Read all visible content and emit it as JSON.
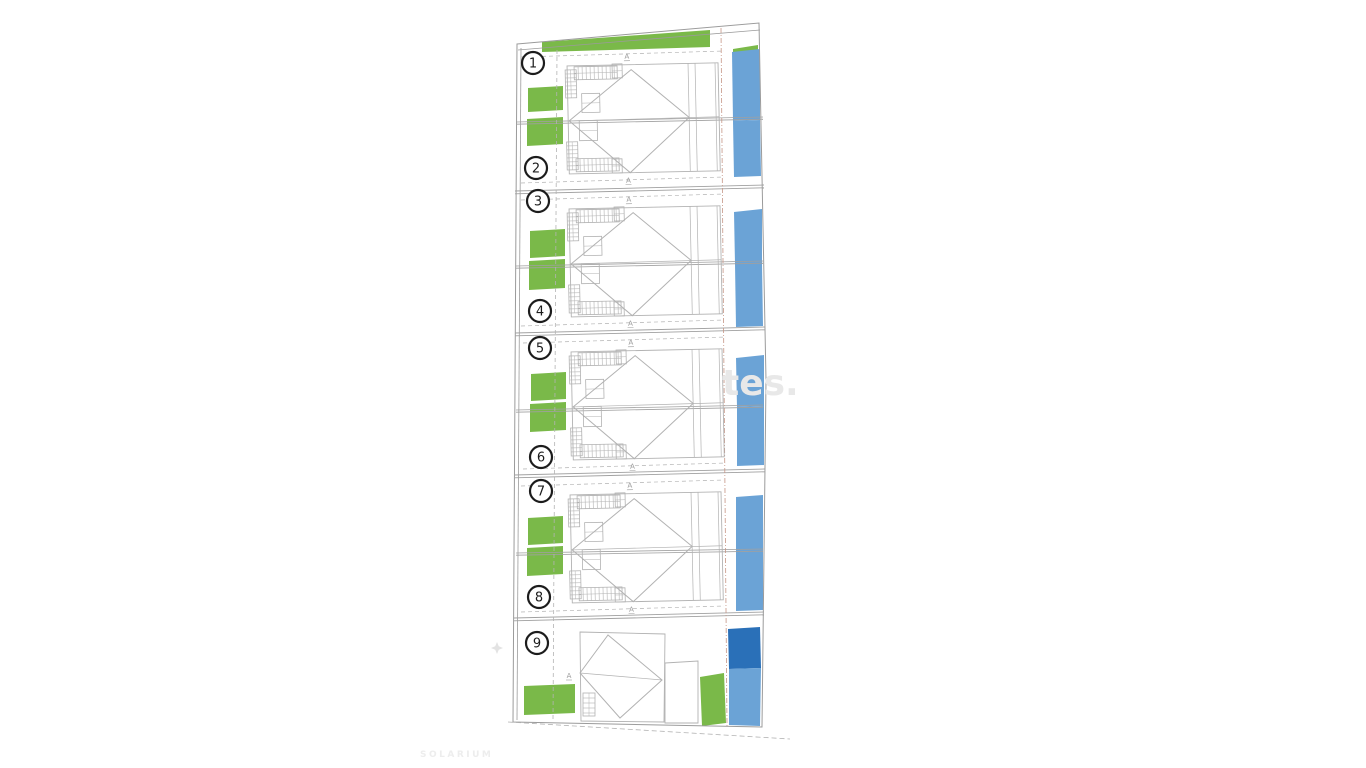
{
  "plan": {
    "colors": {
      "green": "#7ab949",
      "pool": "#6ba3d6",
      "pool_dark": "#2a70b8",
      "boundary_line": "#9b9b9b",
      "plot_line": "#a0a0a0",
      "building_line": "#b2b2b2",
      "dash_gray": "#b3b3b3",
      "dash_red": "#c59585",
      "circle_stroke": "#1c1c1c",
      "number_color": "#1c1c1c",
      "marker_gray": "#9a9a9a",
      "watermark_gray": "#e8e8e8"
    },
    "boundary": {
      "outer": "517,44 759,23 766,380 762,727 513,722",
      "inner_lines": [
        [
          518,
          50,
          760,
          30
        ],
        [
          521,
          48,
          517,
          720
        ]
      ],
      "bottom_dash": [
        508,
        722,
        790,
        739
      ]
    },
    "greens": [
      "542,42 710,30 710,47 542,52",
      "733,49 758,45 758,53 733,54",
      "528,88 563,86 563,110 528,112",
      "527,119 563,117 563,144 527,146",
      "530,231 565,229 565,256 530,258",
      "529,261 565,259 565,288 529,290",
      "531,374 566,372 566,399 531,401",
      "530,404 566,402 566,430 530,432",
      "528,518 563,516 563,543 528,545",
      "527,548 563,546 563,574 527,576",
      "524,686 575,684 575,713 524,715",
      "700,677 724,673 726,723 702,726"
    ],
    "pools": [
      {
        "pts": "732,52 760,49 760,120 733,121",
        "dark": false
      },
      {
        "pts": "733,121 760,120 761,176 734,177",
        "dark": false
      },
      {
        "pts": "734,212 762,209 762,263 735,264",
        "dark": false
      },
      {
        "pts": "735,264 762,263 763,326 736,327",
        "dark": false
      },
      {
        "pts": "736,358 764,355 764,406 737,407",
        "dark": false
      },
      {
        "pts": "737,407 764,406 764,465 737,466",
        "dark": false
      },
      {
        "pts": "736,497 763,495 763,551 736,552",
        "dark": false
      },
      {
        "pts": "736,552 763,551 763,610 736,611",
        "dark": false
      },
      {
        "pts": "728,629 760,627 761,668 729,669",
        "dark": true
      },
      {
        "pts": "729,669 761,668 760,726 729,725",
        "dark": false
      }
    ],
    "dividers": [
      [
        515,
        191,
        764,
        185
      ],
      [
        515,
        333,
        765,
        327
      ],
      [
        514,
        475,
        765,
        469
      ],
      [
        514,
        618,
        764,
        612
      ]
    ],
    "mid_walls": [
      [
        516,
        122,
        763,
        117
      ],
      [
        516,
        266,
        763,
        261
      ],
      [
        516,
        410,
        763,
        405
      ],
      [
        516,
        553,
        763,
        549
      ]
    ],
    "setback_dashes": [
      [
        521,
        57,
        724,
        51
      ],
      [
        521,
        183,
        724,
        177
      ],
      [
        521,
        200,
        724,
        194
      ],
      [
        521,
        326,
        724,
        320
      ],
      [
        523,
        343,
        726,
        337
      ],
      [
        523,
        469,
        726,
        463
      ],
      [
        521,
        486,
        724,
        480
      ],
      [
        521,
        612,
        724,
        606
      ]
    ],
    "vertical_dashes": [
      {
        "pts": [
          557,
          50,
          553,
          720
        ],
        "style": "gray"
      },
      {
        "pts": [
          721,
          28,
          727,
          726
        ],
        "style": "red"
      }
    ],
    "duplex": {
      "instances": [
        [
          565,
          64
        ],
        [
          567,
          207
        ],
        [
          569,
          350
        ],
        [
          568,
          493
        ]
      ],
      "template": {
        "w": 153,
        "h": 110,
        "footprint": [
          2,
          2,
          151,
          108
        ],
        "vlines": [
          123,
          130,
          150
        ],
        "diamond": "3,57 66,7 123,56 63,110",
        "midline": [
          2,
          57,
          153,
          56
        ],
        "hatches": [
          {
            "x": 9,
            "y": 3,
            "w": 43,
            "h": 13,
            "dir": "v",
            "step": 4
          },
          {
            "x": 0,
            "y": 6,
            "w": 11,
            "h": 28,
            "dir": "h",
            "step": 4
          },
          {
            "x": 0,
            "y": 78,
            "w": 11,
            "h": 28,
            "dir": "h",
            "step": 4
          },
          {
            "x": 9,
            "y": 95,
            "w": 43,
            "h": 13,
            "dir": "v",
            "step": 4
          }
        ],
        "rooms": [
          [
            16,
            30,
            18,
            19
          ],
          [
            13,
            57,
            18,
            20
          ],
          [
            47,
            1,
            10,
            14
          ],
          [
            45,
            96,
            10,
            14
          ]
        ],
        "a_markers": [
          {
            "x": 62,
            "y": -4,
            "flip": false
          },
          {
            "x": 61,
            "y": 120,
            "flip": true
          }
        ]
      }
    },
    "house9": {
      "footprint": "580,632 665,634 664,722 581,721",
      "diamond": "580,673 608,635 662,680 620,718",
      "midline": [
        580,
        673,
        662,
        680
      ],
      "garage": "665,663 698,661 698,723 665,723",
      "stairs": {
        "x": 583,
        "y": 693,
        "w": 12,
        "h": 23,
        "dir": "h",
        "step": 5
      },
      "a_marker": {
        "x": 569,
        "y": 678
      }
    },
    "plot_circles": [
      {
        "n": "1",
        "x": 533,
        "y": 63
      },
      {
        "n": "2",
        "x": 536,
        "y": 168
      },
      {
        "n": "3",
        "x": 538,
        "y": 201
      },
      {
        "n": "4",
        "x": 540,
        "y": 311
      },
      {
        "n": "5",
        "x": 540,
        "y": 348
      },
      {
        "n": "6",
        "x": 541,
        "y": 457
      },
      {
        "n": "7",
        "x": 541,
        "y": 491
      },
      {
        "n": "8",
        "x": 539,
        "y": 597
      },
      {
        "n": "9",
        "x": 537,
        "y": 643
      }
    ],
    "compass": {
      "x": 497,
      "y": 648
    },
    "watermarks": [
      {
        "text": "tes.",
        "x": 722,
        "y": 395,
        "size": 36,
        "weight": 600,
        "spacing": 0,
        "color": "#e8e8e8"
      },
      {
        "text": "SOLARIUM",
        "x": 420,
        "y": 757,
        "size": 9,
        "weight": 700,
        "spacing": 2.5,
        "color": "#ededed"
      }
    ]
  }
}
